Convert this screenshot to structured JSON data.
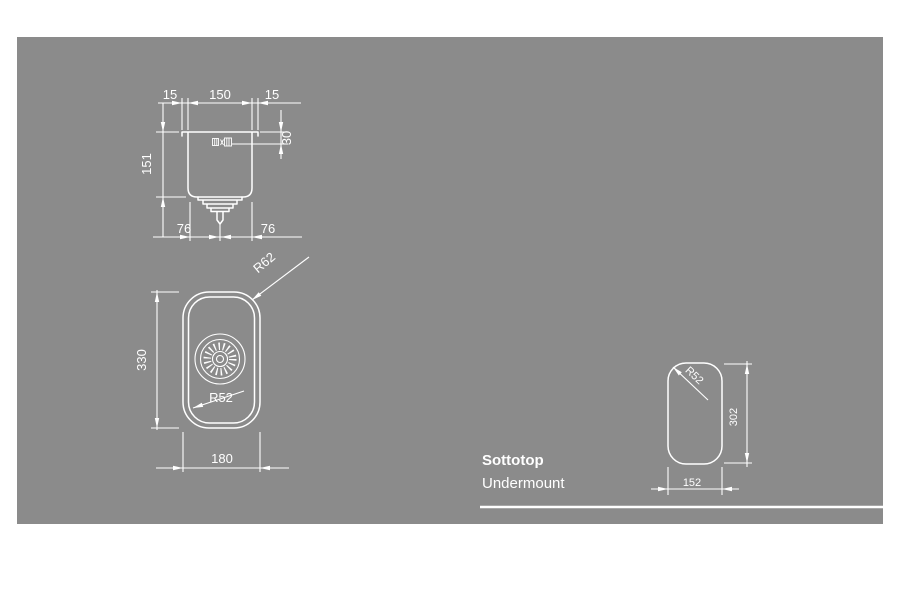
{
  "page": {
    "background": "#ffffff",
    "panel_color": "#8b8b8b",
    "line_color": "#ffffff"
  },
  "caption": {
    "title": "Sottotop",
    "subtitle": "Undermount"
  },
  "section_view": {
    "dim_rim_left": "15",
    "dim_basin_width": "150",
    "dim_rim_right": "15",
    "dim_depth": "151",
    "dim_overflow_offset": "30",
    "dim_drain_left": "76",
    "dim_drain_right": "76"
  },
  "plan_view": {
    "dim_length": "330",
    "dim_width": "180",
    "radius_outer": "R62",
    "radius_inner": "R52"
  },
  "cutout_view": {
    "radius": "R52",
    "dim_length": "302",
    "dim_width": "152"
  }
}
